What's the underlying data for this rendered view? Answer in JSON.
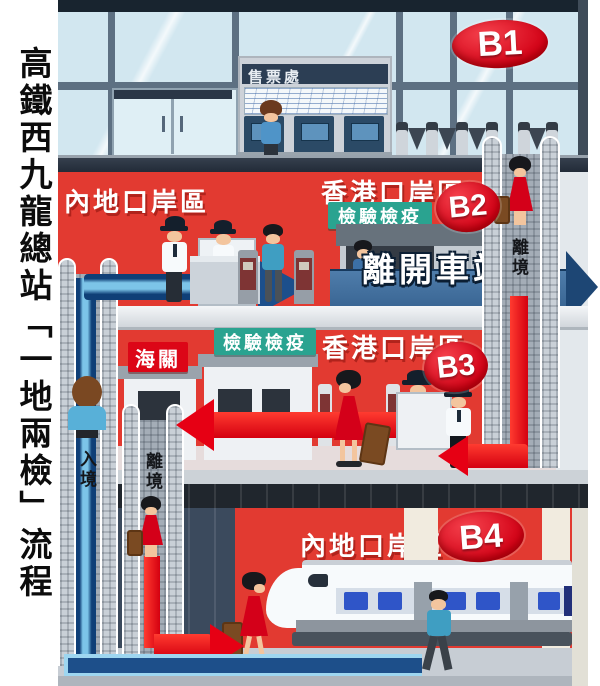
{
  "caption": {
    "vertical_title": "高鐵西九龍總站「一地兩檢」流程"
  },
  "badges": {
    "b1": "B1",
    "b2": "B2",
    "b3": "B3",
    "b4": "B4"
  },
  "b1": {
    "ticket_sign": "售票處"
  },
  "b2": {
    "mainland_zone": "內地口岸區",
    "hk_zone": "香港口岸區",
    "quarantine": "檢驗檢疫",
    "leave_station": "離開車站"
  },
  "b3": {
    "customs": "海關",
    "quarantine": "檢驗檢疫",
    "hk_zone": "香港口岸區"
  },
  "b4": {
    "mainland_zone": "內地口岸區"
  },
  "escalators": {
    "arrival": "入境",
    "departure_mid": "離境",
    "departure_right": "離境"
  },
  "colors": {
    "zone_red": "#e23a31",
    "badge_red": "#dc0617",
    "quarantine_teal": "#2aa390",
    "arrival_path_blue": "#1d4f8a",
    "leave_arrow_blue": "#41719f",
    "departure_path_red": "#e60014"
  }
}
